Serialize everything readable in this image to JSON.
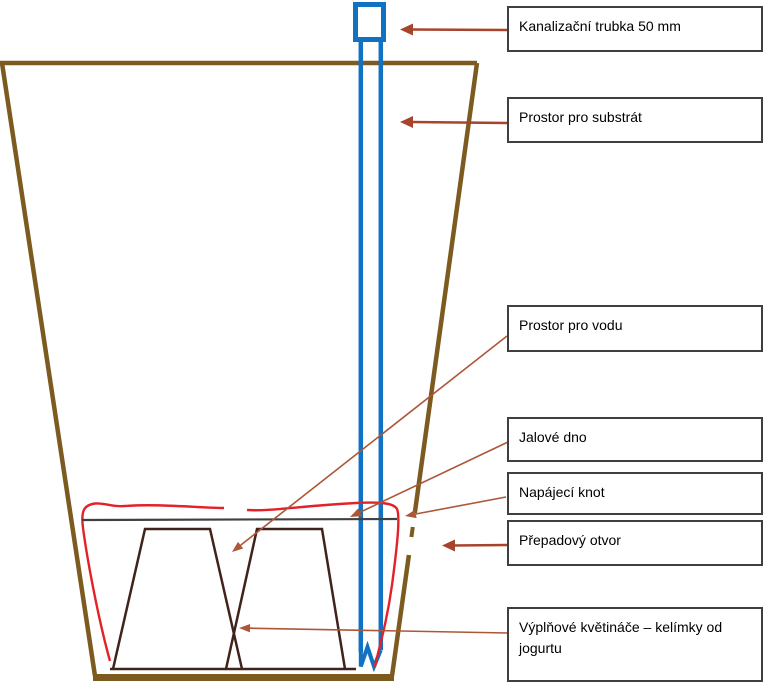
{
  "labels": [
    {
      "id": "pipe",
      "text": "Kanalizační trubka 50 mm"
    },
    {
      "id": "substrate",
      "text": "Prostor pro substrát"
    },
    {
      "id": "water",
      "text": "Prostor pro vodu"
    },
    {
      "id": "false-bottom",
      "text": "Jalové dno"
    },
    {
      "id": "wick",
      "text": "Napájecí knot"
    },
    {
      "id": "overflow",
      "text": "Přepadový otvor"
    },
    {
      "id": "filler-cups",
      "text": "Výplňové květináče – kelímky od jogurtu"
    }
  ],
  "colors": {
    "pot_brown": "#7D5A1F",
    "cup_dark_brown": "#40231A",
    "wick_red": "#E32128",
    "pipe_blue": "#1171C2",
    "arrow_brick": "#A8432C",
    "leader_brick": "#AD5638",
    "box_border_gray": "#3F3F3F",
    "false_bottom_gray": "#404040",
    "text_black": "#000000",
    "background": "#FFFFFF"
  }
}
